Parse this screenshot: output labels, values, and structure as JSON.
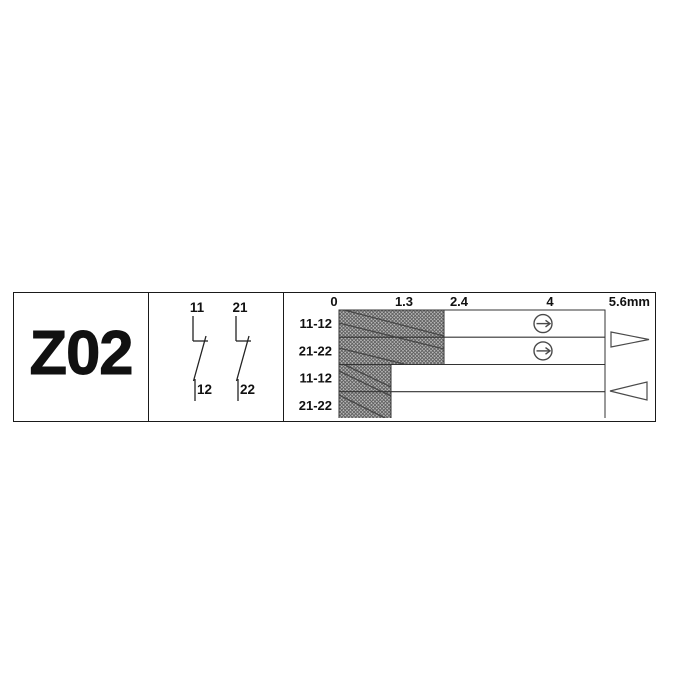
{
  "panel_left": {
    "model": "Z02"
  },
  "panel_middle": {
    "contacts": [
      {
        "top_label": "11",
        "bottom_label": "12",
        "type": "NC contact symbol"
      },
      {
        "top_label": "21",
        "bottom_label": "22",
        "type": "NC contact symbol"
      }
    ]
  },
  "panel_right": {
    "scale": {
      "ticks": [
        "0",
        "1.3",
        "2.4",
        "4"
      ],
      "end_tick": "5.6mm"
    },
    "rows": [
      {
        "label": "11-12"
      },
      {
        "label": "21-22"
      },
      {
        "label": "11-12"
      },
      {
        "label": "21-22"
      }
    ],
    "icons": {
      "positive_opening": "circle-right-arrow",
      "actuation_direction": "triangle-right",
      "return_direction": "triangle-left"
    }
  },
  "chart_data": {
    "type": "bar",
    "title": "Contact travel diagram Z02",
    "unit": "mm",
    "xlim": [
      0,
      5.6
    ],
    "x_ticks": [
      0,
      1.3,
      2.4,
      4,
      5.6
    ],
    "rows": [
      {
        "label": "11-12",
        "direction": "actuation",
        "closed_range_mm": [
          0,
          2.4
        ],
        "positive_opening_at_mm": 4
      },
      {
        "label": "21-22",
        "direction": "actuation",
        "closed_range_mm": [
          0,
          2.4
        ],
        "positive_opening_at_mm": 4
      },
      {
        "label": "11-12",
        "direction": "return",
        "closed_range_mm": [
          0,
          1.3
        ]
      },
      {
        "label": "21-22",
        "direction": "return",
        "closed_range_mm": [
          0,
          1.3
        ]
      }
    ],
    "legend_hint": "hatched = contact closed, white = contact open"
  },
  "colors": {
    "line": "#1a1a1a",
    "thin_line": "#333333",
    "symbol_stroke": "#4a4a4a",
    "hatch_base": "#b9b9b9",
    "hatch_line": "#5f5f5f",
    "background": "#ffffff"
  }
}
